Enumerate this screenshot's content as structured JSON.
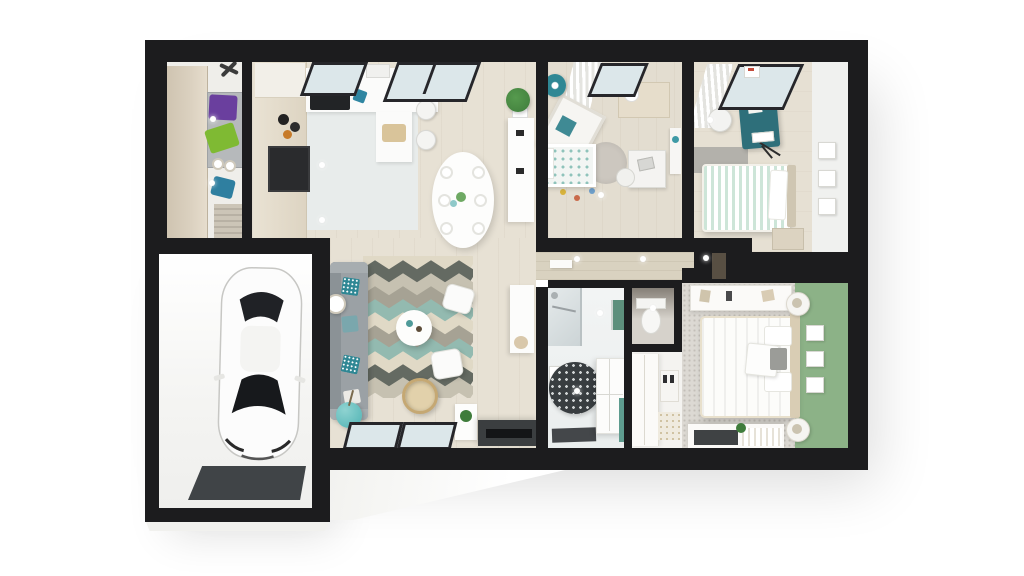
{
  "scene": {
    "type": "3d-rendered-floor-plan",
    "view": "top-down dollhouse cutaway of a single-storey house with attached garage",
    "rooms": [
      {
        "name": "utility-room",
        "furniture": [
          "tall-wardrobe",
          "washer-dryer-stack",
          "purple-laundry-basket",
          "green-laundry-basket",
          "blue-storage-bin",
          "door-mat",
          "ceiling-fan"
        ]
      },
      {
        "name": "garage",
        "furniture": [
          "white-car",
          "garage-door-mat"
        ]
      },
      {
        "name": "kitchen",
        "furniture": [
          "tall-cabinet-column",
          "oven",
          "cooktop",
          "sink-counter",
          "peninsula-counter",
          "cutting-board",
          "bar-stools",
          "ceiling-vent"
        ]
      },
      {
        "name": "dining-area",
        "furniture": [
          "oval-table",
          "eight-chairs",
          "plates",
          "potted-plant",
          "sideboard"
        ]
      },
      {
        "name": "living-room",
        "furniture": [
          "grey-sofa",
          "patterned-pillows",
          "chevron-rug",
          "round-coffee-table",
          "two-white-poufs",
          "rattan-hanging-chair",
          "teal-sphere-table",
          "floor-lamp",
          "tv-console",
          "tv",
          "media-shelf",
          "plant-pot",
          "picture-windows"
        ]
      },
      {
        "name": "kids-bedroom",
        "furniture": [
          "teal-lamp",
          "window-with-curtains",
          "dresser",
          "crib",
          "bed-teal-dot-duvet",
          "round-rug",
          "desk",
          "desk-chair",
          "wall-shelf",
          "toys"
        ]
      },
      {
        "name": "bedroom-2",
        "furniture": [
          "window-with-curtains",
          "teal-desk",
          "white-chair",
          "mint-striped-bed",
          "white-pillow",
          "grey-side-rug",
          "nightstand",
          "music-stand",
          "three-wall-frames"
        ]
      },
      {
        "name": "hallway",
        "furniture": [
          "ceiling-spotlights",
          "wall-shelf",
          "door"
        ]
      },
      {
        "name": "bathroom",
        "furniture": [
          "glass-shower",
          "green-towel-rail",
          "round-patterned-rug",
          "storage-cabinet",
          "dark-bath-mat",
          "wall-frame"
        ]
      },
      {
        "name": "wc",
        "furniture": [
          "toilet"
        ]
      },
      {
        "name": "master-bedroom",
        "furniture": [
          "green-accent-wall",
          "double-bed",
          "white-cushion",
          "grey-cushion",
          "round-nightstands-with-lamps",
          "wardrobe",
          "three-wall-frames",
          "bench-dresser",
          "plant",
          "dressing-wardrobe",
          "shoe-rack"
        ]
      }
    ]
  },
  "palette": {
    "bg": "#ffffff",
    "wall": "#1c1c1e",
    "woodA": "#e7e1d4",
    "woodB": "#e3ddd0",
    "woodC": "#e6e0d3",
    "woodHall": "#d9d2c0",
    "tile": "#e8eceb",
    "bathWall": "#f2f4f4",
    "bathFloor": "#eaeeee",
    "carpet": "#dcd9d3",
    "greenWall": "#8cb287",
    "mint": "#cde5d8",
    "teal": "#2f8794",
    "tealDark": "#2e6f7a",
    "tealLight": "#62bcbc",
    "sofa": "#9ba1a5",
    "rugA": "#e0d9c6",
    "rugB": "#646a62",
    "rugC": "#a6a294",
    "rugD": "#93bab0",
    "rugE": "#c6c1b1",
    "darkUnit": "#3b3e40",
    "beige": "#dbd1c0",
    "beige2": "#cec3b0",
    "purple": "#6a3f9e",
    "lime": "#7fba33",
    "blueBin": "#2f7fa0",
    "glass": "#dce7ea",
    "frame": "#26262a",
    "plant": "#3f7c3b",
    "towel": "#5d8f7c",
    "mat": "#44474a",
    "carBody": "#fcfcfc",
    "carGlass": "#1b1d20"
  }
}
